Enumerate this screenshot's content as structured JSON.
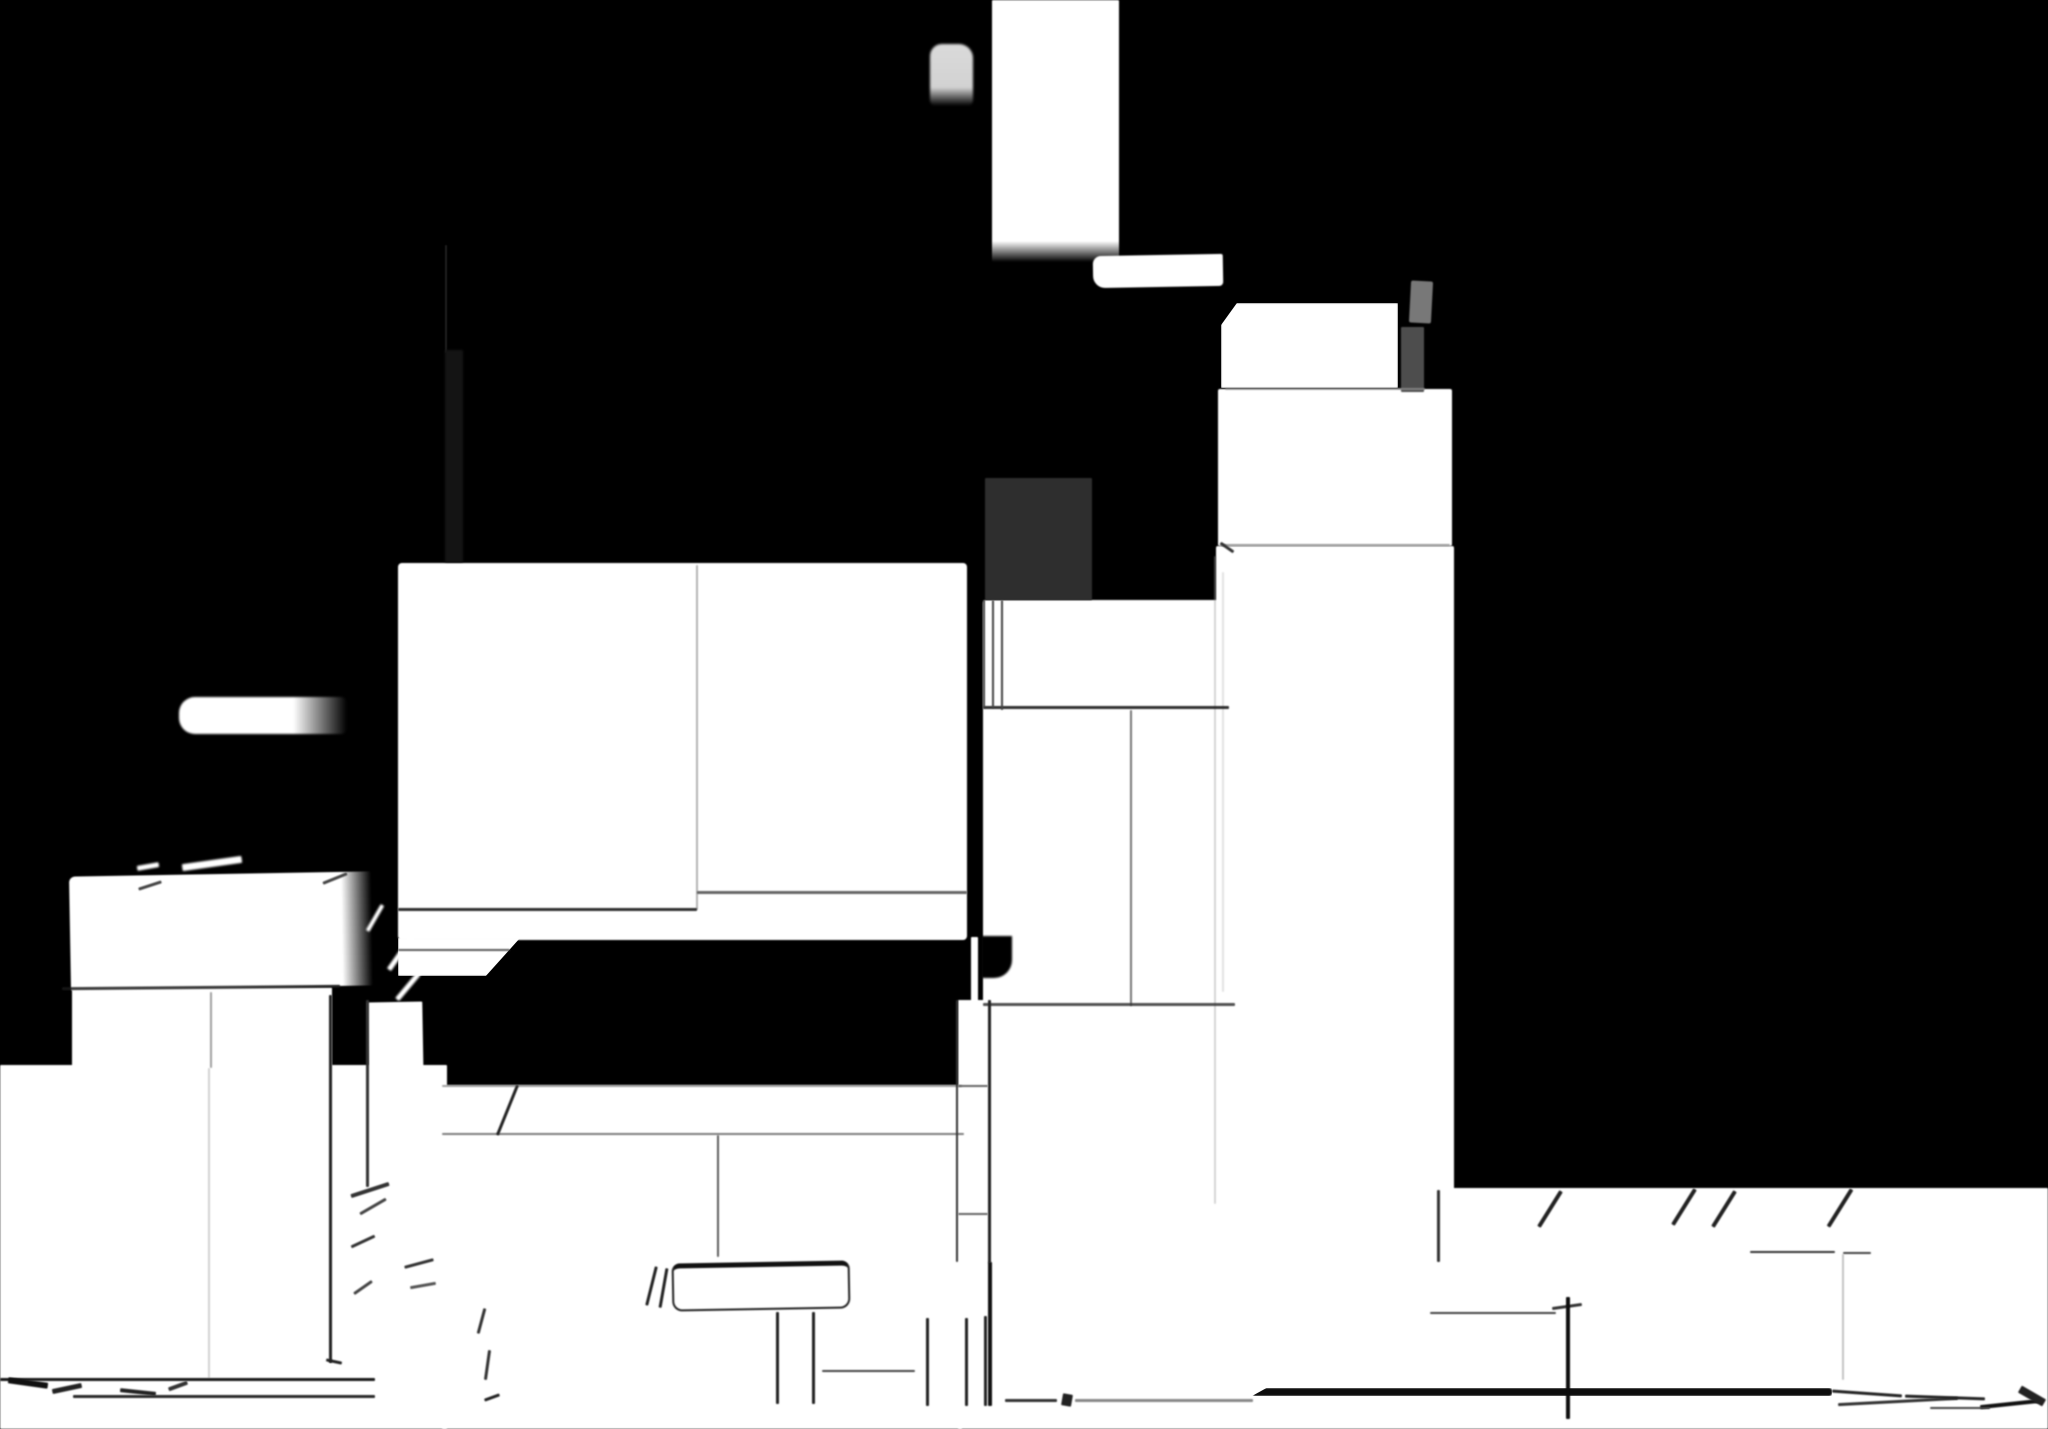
{
  "canvas": {
    "width": 2048,
    "height": 1429,
    "background": "#000000"
  },
  "palette": {
    "background": "#000000",
    "shape_white": "#ffffff",
    "blob_light_gray": "#d9d9d9",
    "tab_gray": "#787878",
    "post_gray": "#4d4d4d",
    "panel_dark_gray": "#2e2e2e",
    "seam_gray": "#777777",
    "line_dark": "#1a1a1a"
  },
  "shapes": [
    {
      "n": "top-bar",
      "x": 992,
      "y": 0,
      "w": 127,
      "h": 262,
      "bg": "linear-gradient(180deg,#ffffff 0%,#ffffff 92%,rgba(255,255,255,0) 100%)"
    },
    {
      "n": "top-blob",
      "x": 930,
      "y": 44,
      "w": 43,
      "h": 62,
      "bg": "linear-gradient(180deg,#dadada 0%,#d2d2d2 70%,rgba(210,210,210,0) 100%)",
      "r": "12px 14px 6px 6px",
      "blur": 1.3
    },
    {
      "n": "ledge-strip",
      "x": 1093,
      "y": 255,
      "w": 130,
      "h": 32,
      "r": "8px 2px 4px 12px",
      "rot": -1
    },
    {
      "n": "tower-cap",
      "x": 1221,
      "y": 303,
      "w": 177,
      "h": 85,
      "clip": "polygon(9% 0,100% 0,100% 100%,0 100%,0 26%)"
    },
    {
      "n": "tower-upper",
      "x": 1218,
      "y": 389,
      "w": 234,
      "h": 157,
      "r": "2px"
    },
    {
      "n": "tower-body",
      "x": 1216,
      "y": 546,
      "w": 238,
      "h": 660,
      "r": "2px"
    },
    {
      "n": "mid-columns",
      "x": 983,
      "y": 600,
      "w": 244,
      "h": 602,
      "r": "3px"
    },
    {
      "n": "mid-columns-notch",
      "x": 981,
      "y": 936,
      "w": 31,
      "h": 42,
      "bg": "#000000",
      "r": "0 0 18px 2px",
      "blur": 1
    },
    {
      "n": "thin-pole",
      "x": 971,
      "y": 937,
      "w": 7,
      "h": 70
    },
    {
      "n": "thin-column",
      "x": 958,
      "y": 1000,
      "w": 30,
      "h": 262
    },
    {
      "n": "left-box",
      "x": 70,
      "y": 874,
      "w": 302,
      "h": 114,
      "bg": "linear-gradient(90deg,#ffffff 0%,#ffffff 90%,rgba(255,255,255,0) 100%)",
      "rot": -1,
      "r": "6px 2px 2px 2px"
    },
    {
      "n": "left-band",
      "x": 72,
      "y": 987,
      "w": 260,
      "h": 84
    },
    {
      "n": "narrow-column",
      "x": 368,
      "y": 1002,
      "w": 55,
      "h": 86,
      "rot": -1
    },
    {
      "n": "center-slab",
      "x": 398,
      "y": 563,
      "w": 569,
      "h": 377,
      "r": "4px"
    },
    {
      "n": "center-slab-tail",
      "x": 398,
      "y": 938,
      "w": 122,
      "h": 38,
      "clip": "polygon(0 0,100% 0,72% 100%,0 100%)"
    },
    {
      "n": "side-pill",
      "x": 179,
      "y": 697,
      "w": 168,
      "h": 37,
      "bg": "linear-gradient(90deg,#ffffff 0%,#ffffff 68%,rgba(255,255,255,0) 100%)",
      "r": "16px 6px 6px 16px",
      "blur": 1
    },
    {
      "n": "floor-left",
      "x": 0,
      "y": 1065,
      "w": 447,
      "h": 364
    },
    {
      "n": "floor-center",
      "x": 442,
      "y": 1085,
      "w": 520,
      "h": 344
    },
    {
      "n": "floor-right",
      "x": 958,
      "y": 1188,
      "w": 1090,
      "h": 241
    },
    {
      "n": "bench-outline",
      "x": 672,
      "y": 1262,
      "w": 178,
      "h": 48,
      "bg": "#ffffff",
      "border": "2px solid #222222",
      "bt": "5px solid #111111",
      "r": "8px 8px 10px 10px",
      "rot": -1
    },
    {
      "n": "wedge-mark-1",
      "x": 182,
      "y": 860,
      "w": 60,
      "h": 7,
      "rot": -8,
      "blur": 1
    },
    {
      "n": "wedge-mark-2",
      "x": 137,
      "y": 864,
      "w": 22,
      "h": 5,
      "rot": -10,
      "blur": 1
    },
    {
      "n": "corner-hatch-1",
      "x": 380,
      "y": 950,
      "w": 42,
      "h": 5,
      "rot": -55,
      "blur": 1
    },
    {
      "n": "corner-hatch-2",
      "x": 391,
      "y": 984,
      "w": 34,
      "h": 5,
      "rot": -50,
      "blur": 1
    },
    {
      "n": "corner-hatch-3",
      "x": 360,
      "y": 916,
      "w": 30,
      "h": 4,
      "rot": -60,
      "blur": 1
    },
    {
      "n": "gray-tab",
      "x": 1410,
      "y": 281,
      "w": 22,
      "h": 42,
      "bg": "#787878",
      "rot": 3,
      "r": "2px"
    },
    {
      "n": "gray-post",
      "x": 1401,
      "y": 327,
      "w": 23,
      "h": 65,
      "bg": "#4d4d4d"
    },
    {
      "n": "dark-panel",
      "x": 985,
      "y": 478,
      "w": 107,
      "h": 122,
      "bg": "#2e2e2e"
    },
    {
      "n": "dark-hairline",
      "x": 445,
      "y": 245,
      "w": 2,
      "h": 108,
      "bg": "#1e1e1e",
      "blur": 0.5
    },
    {
      "n": "dark-column-shadow",
      "x": 445,
      "y": 350,
      "w": 18,
      "h": 212,
      "bg": "#141414",
      "blur": 1
    },
    {
      "n": "tower-seam-1",
      "x": 1225,
      "y": 388,
      "w": 200,
      "h": 2,
      "bg": "#999999",
      "op": 0.7
    },
    {
      "n": "tower-seam-2",
      "x": 1220,
      "y": 544,
      "w": 230,
      "h": 2,
      "bg": "#888888",
      "op": 0.8
    },
    {
      "n": "tower-seam-slant",
      "x": 1219,
      "y": 546,
      "w": 16,
      "h": 3,
      "bg": "#333333",
      "rot": 35
    },
    {
      "n": "tower-edge-seam-1",
      "x": 1214,
      "y": 556,
      "w": 2,
      "h": 648,
      "bg": "#999999",
      "op": 0.4
    },
    {
      "n": "tower-edge-seam-2",
      "x": 1222,
      "y": 572,
      "w": 2,
      "h": 420,
      "bg": "#aaaaaa",
      "op": 0.35
    },
    {
      "n": "mid-seam-top",
      "x": 983,
      "y": 706,
      "w": 246,
      "h": 3,
      "bg": "#1a1a1a",
      "op": 0.9
    },
    {
      "n": "mid-strip-line-1",
      "x": 983,
      "y": 600,
      "w": 2,
      "h": 108,
      "bg": "#444444"
    },
    {
      "n": "mid-strip-line-2",
      "x": 992,
      "y": 600,
      "w": 2,
      "h": 108,
      "bg": "#444444"
    },
    {
      "n": "mid-strip-line-3",
      "x": 1001,
      "y": 600,
      "w": 2,
      "h": 110,
      "bg": "#444444"
    },
    {
      "n": "mid-column-seam",
      "x": 1130,
      "y": 710,
      "w": 2,
      "h": 296,
      "bg": "#555555",
      "op": 0.8
    },
    {
      "n": "mid-seam-bottom",
      "x": 983,
      "y": 1003,
      "w": 252,
      "h": 3,
      "bg": "#333333",
      "op": 0.85
    },
    {
      "n": "slab-vertical-seam",
      "x": 696,
      "y": 565,
      "w": 2,
      "h": 345,
      "bg": "#777777",
      "op": 0.55
    },
    {
      "n": "slab-seam-left",
      "x": 398,
      "y": 908,
      "w": 299,
      "h": 3,
      "bg": "#1a1a1a",
      "op": 0.9
    },
    {
      "n": "slab-seam-right",
      "x": 697,
      "y": 891,
      "w": 270,
      "h": 3,
      "bg": "#333333",
      "op": 0.75
    },
    {
      "n": "tail-edge-line",
      "x": 398,
      "y": 949,
      "w": 112,
      "h": 2,
      "bg": "#333333",
      "op": 0.8
    },
    {
      "n": "left-box-seam",
      "x": 62,
      "y": 986,
      "w": 278,
      "h": 3,
      "bg": "#1a1a1a",
      "rot": -0.5,
      "op": 0.85
    },
    {
      "n": "left-box-tick-1",
      "x": 322,
      "y": 877,
      "w": 26,
      "h": 3,
      "bg": "#444444",
      "rot": -22
    },
    {
      "n": "left-box-tick-2",
      "x": 138,
      "y": 884,
      "w": 24,
      "h": 3,
      "bg": "#444444",
      "rot": -18
    },
    {
      "n": "left-column-seam-1",
      "x": 210,
      "y": 992,
      "w": 2,
      "h": 76,
      "bg": "#777777",
      "op": 0.7
    },
    {
      "n": "left-column-seam-2",
      "x": 208,
      "y": 1068,
      "w": 2,
      "h": 310,
      "bg": "#999999",
      "op": 0.45
    },
    {
      "n": "left-column-edge",
      "x": 329,
      "y": 995,
      "w": 3,
      "h": 368,
      "bg": "#222222"
    },
    {
      "n": "left-column-edge-foot",
      "x": 326,
      "y": 1360,
      "w": 16,
      "h": 3,
      "bg": "#222222",
      "rot": 12
    },
    {
      "n": "narrow-column-edge",
      "x": 366,
      "y": 1000,
      "w": 3,
      "h": 187,
      "bg": "#333333"
    },
    {
      "n": "floor-seam",
      "x": 442,
      "y": 1133,
      "w": 522,
      "h": 2,
      "bg": "#666666",
      "op": 0.85
    },
    {
      "n": "floor-seam-drop",
      "x": 717,
      "y": 1135,
      "w": 2,
      "h": 122,
      "bg": "#333333",
      "op": 0.8
    },
    {
      "n": "floor-step-slant",
      "x": 506,
      "y": 1083,
      "w": 3,
      "h": 54,
      "bg": "#222222",
      "rot": 22
    },
    {
      "n": "floor-center-edge",
      "x": 442,
      "y": 1085,
      "w": 520,
      "h": 2,
      "bg": "#444444",
      "op": 0.5
    },
    {
      "n": "thin-column-edge-left",
      "x": 956,
      "y": 1000,
      "w": 2,
      "h": 262,
      "bg": "#333333"
    },
    {
      "n": "thin-column-edge-right",
      "x": 988,
      "y": 1000,
      "w": 3,
      "h": 263,
      "bg": "#222222"
    },
    {
      "n": "thin-column-joint-1",
      "x": 958,
      "y": 1085,
      "w": 30,
      "h": 2,
      "bg": "#666666"
    },
    {
      "n": "thin-column-joint-2",
      "x": 958,
      "y": 1213,
      "w": 30,
      "h": 2,
      "bg": "#666666"
    },
    {
      "n": "heavy-post-line",
      "x": 988,
      "y": 1262,
      "w": 4,
      "h": 144,
      "bg": "#111111"
    },
    {
      "n": "bench-leg-1",
      "x": 776,
      "y": 1312,
      "w": 3,
      "h": 92,
      "bg": "#222222"
    },
    {
      "n": "bench-leg-2",
      "x": 812,
      "y": 1312,
      "w": 3,
      "h": 92,
      "bg": "#222222"
    },
    {
      "n": "bench-rail",
      "x": 822,
      "y": 1370,
      "w": 93,
      "h": 2,
      "bg": "#444444"
    },
    {
      "n": "post-line-1",
      "x": 926,
      "y": 1318,
      "w": 3,
      "h": 88,
      "bg": "#222222"
    },
    {
      "n": "post-line-2",
      "x": 965,
      "y": 1318,
      "w": 3,
      "h": 88,
      "bg": "#222222"
    },
    {
      "n": "post-line-3",
      "x": 984,
      "y": 1316,
      "w": 3,
      "h": 90,
      "bg": "#222222"
    },
    {
      "n": "bench-mark-1",
      "x": 650,
      "y": 1266,
      "w": 3,
      "h": 40,
      "bg": "#222222",
      "rot": 14
    },
    {
      "n": "bench-mark-2",
      "x": 662,
      "y": 1268,
      "w": 3,
      "h": 40,
      "bg": "#222222",
      "rot": 10
    },
    {
      "n": "floor-line-gray",
      "x": 1075,
      "y": 1399,
      "w": 178,
      "h": 3,
      "bg": "#888888"
    },
    {
      "n": "floor-line-heavy",
      "x": 1252,
      "y": 1388,
      "w": 580,
      "h": 8,
      "bg": "#0d0d0d",
      "r": "3px",
      "clip": "polygon(0 100%,2.5% 0,100% 0,100% 100%)"
    },
    {
      "n": "floor-dash-a",
      "x": 1005,
      "y": 1399,
      "w": 52,
      "h": 3,
      "bg": "#333333"
    },
    {
      "n": "floor-dash-b",
      "x": 1062,
      "y": 1394,
      "w": 10,
      "h": 12,
      "bg": "#222222",
      "rot": 10
    },
    {
      "n": "right-ledge-line",
      "x": 1430,
      "y": 1312,
      "w": 126,
      "h": 2,
      "bg": "#444444"
    },
    {
      "n": "right-ledge-jog",
      "x": 1552,
      "y": 1305,
      "w": 30,
      "h": 3,
      "bg": "#333333",
      "rot": -8
    },
    {
      "n": "right-dash-1",
      "x": 1750,
      "y": 1251,
      "w": 85,
      "h": 2,
      "bg": "#333333"
    },
    {
      "n": "right-dash-2",
      "x": 1843,
      "y": 1252,
      "w": 28,
      "h": 2,
      "bg": "#444444"
    },
    {
      "n": "right-faint-post",
      "x": 1842,
      "y": 1254,
      "w": 2,
      "h": 126,
      "bg": "#888888",
      "op": 0.5
    },
    {
      "n": "right-post-small",
      "x": 1437,
      "y": 1190,
      "w": 3,
      "h": 72,
      "bg": "#333333"
    },
    {
      "n": "right-post-strong",
      "x": 1566,
      "y": 1297,
      "w": 4,
      "h": 122,
      "bg": "#0d0d0d"
    },
    {
      "n": "boundary-slash-1",
      "x": 1548,
      "y": 1188,
      "w": 4,
      "h": 42,
      "bg": "#222222",
      "rot": 32
    },
    {
      "n": "boundary-slash-2",
      "x": 1682,
      "y": 1186,
      "w": 4,
      "h": 42,
      "bg": "#222222",
      "rot": 32
    },
    {
      "n": "boundary-slash-3",
      "x": 1722,
      "y": 1188,
      "w": 4,
      "h": 42,
      "bg": "#222222",
      "rot": 32
    },
    {
      "n": "boundary-slash-4",
      "x": 1838,
      "y": 1186,
      "w": 4,
      "h": 44,
      "bg": "#222222",
      "rot": 32
    },
    {
      "n": "floor-hatch-1",
      "x": 350,
      "y": 1188,
      "w": 40,
      "h": 4,
      "bg": "#333333",
      "rot": -18
    },
    {
      "n": "floor-hatch-2",
      "x": 358,
      "y": 1205,
      "w": 30,
      "h": 3,
      "bg": "#444444",
      "rot": -30
    },
    {
      "n": "floor-hatch-3",
      "x": 350,
      "y": 1240,
      "w": 26,
      "h": 3,
      "bg": "#333333",
      "rot": -25
    },
    {
      "n": "floor-hatch-4",
      "x": 404,
      "y": 1262,
      "w": 30,
      "h": 3,
      "bg": "#333333",
      "rot": -15
    },
    {
      "n": "floor-hatch-5",
      "x": 352,
      "y": 1286,
      "w": 22,
      "h": 3,
      "bg": "#444444",
      "rot": -35
    },
    {
      "n": "floor-hatch-6",
      "x": 410,
      "y": 1284,
      "w": 26,
      "h": 3,
      "bg": "#555555",
      "rot": -10
    },
    {
      "n": "floor-tick-1",
      "x": 480,
      "y": 1308,
      "w": 3,
      "h": 26,
      "bg": "#333333",
      "rot": 15
    },
    {
      "n": "floor-tick-2",
      "x": 486,
      "y": 1350,
      "w": 3,
      "h": 30,
      "bg": "#333333",
      "rot": 8
    },
    {
      "n": "floor-tick-3",
      "x": 484,
      "y": 1396,
      "w": 16,
      "h": 3,
      "bg": "#222222",
      "rot": -20
    },
    {
      "n": "baseline-left",
      "x": 0,
      "y": 1378,
      "w": 375,
      "h": 3,
      "bg": "#1a1a1a"
    },
    {
      "n": "baseline-left-2",
      "x": 73,
      "y": 1395,
      "w": 302,
      "h": 3,
      "bg": "#2a2a2a"
    },
    {
      "n": "corner-dash-1",
      "x": 8,
      "y": 1380,
      "w": 40,
      "h": 6,
      "bg": "#111111",
      "rot": 8
    },
    {
      "n": "corner-dash-2",
      "x": 52,
      "y": 1386,
      "w": 30,
      "h": 5,
      "bg": "#222222",
      "rot": -12
    },
    {
      "n": "corner-dash-3",
      "x": 120,
      "y": 1390,
      "w": 36,
      "h": 4,
      "bg": "#222222",
      "rot": 6
    },
    {
      "n": "corner-dash-4",
      "x": 168,
      "y": 1384,
      "w": 20,
      "h": 4,
      "bg": "#333333",
      "rot": -20
    },
    {
      "n": "right-hatch-1",
      "x": 1832,
      "y": 1392,
      "w": 70,
      "h": 3,
      "bg": "#222222",
      "rot": 4
    },
    {
      "n": "right-hatch-2",
      "x": 1838,
      "y": 1400,
      "w": 120,
      "h": 3,
      "bg": "#333333",
      "rot": -3
    },
    {
      "n": "right-hatch-3",
      "x": 1905,
      "y": 1396,
      "w": 80,
      "h": 3,
      "bg": "#222222",
      "rot": 2
    },
    {
      "n": "right-hatch-4",
      "x": 1980,
      "y": 1402,
      "w": 60,
      "h": 4,
      "bg": "#111111",
      "rot": -6
    },
    {
      "n": "right-hatch-5",
      "x": 2018,
      "y": 1392,
      "w": 28,
      "h": 8,
      "bg": "#222222",
      "rot": 30
    },
    {
      "n": "right-hatch-6",
      "x": 1930,
      "y": 1407,
      "w": 60,
      "h": 2,
      "bg": "#444444"
    }
  ]
}
